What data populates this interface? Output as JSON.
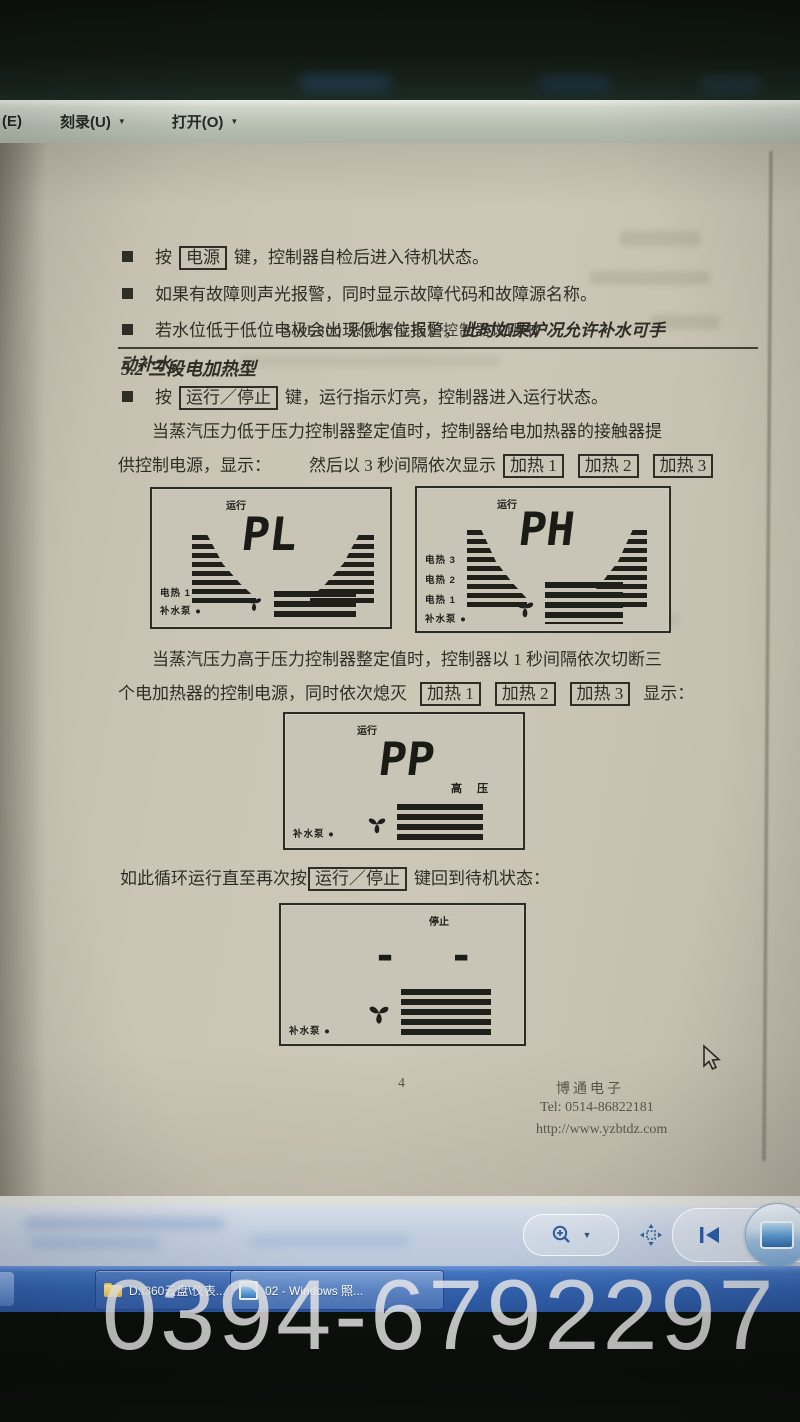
{
  "menu_bar": {
    "edge_item": "(E)",
    "caret": "▼",
    "items": [
      {
        "label": "刻录(U)"
      },
      {
        "label": "打开(O)"
      }
    ]
  },
  "document": {
    "header_title": "SML800 系列智能锅炉控制器说明书",
    "section_heading": "5.2 三段电加热型",
    "bullet_marker": "",
    "bullets": {
      "b1_pre": "按",
      "b1_key": "电源",
      "b1_post": "键，控制器自检后进入待机状态。",
      "b2": "如果有故障则声光报警，同时显示故障代码和故障源名称。",
      "b3_normal": "若水位低于低位电极会出现低水位报警，",
      "b3_em": "此时如果炉况允许补水可手",
      "b3_line2_em": "动补水。",
      "b4_pre": "按",
      "b4_key": "运行／停止",
      "b4_post": "键，运行指示灯亮，控制器进入运行状态。"
    },
    "para1_line1": "当蒸汽压力低于压力控制器整定值时，控制器给电加热器的接触器提",
    "para1_line2_prefix": "供控制电源，显示：",
    "para1_line2_mid": "然后以 3 秒间隔依次显示",
    "heat_buttons": [
      "加热 1",
      "加热 2",
      "加热 3"
    ],
    "para2_line1": "当蒸汽压力高于压力控制器整定值时，控制器以 1 秒间隔依次切断三",
    "para2_line2_prefix": "个电加热器的控制电源，同时依次熄灭",
    "para2_line2_suffix": "显示：",
    "loop_prefix": "如此循环运行直至再次按",
    "loop_key": "运行／停止",
    "loop_suffix": "键回到待机状态：",
    "lcds": [
      {
        "status": "运行",
        "value": "PL",
        "labels": [
          "电热 1",
          "补水泵 ●"
        ]
      },
      {
        "status": "运行",
        "value": "PH",
        "labels": [
          "电热 3",
          "电热 2",
          "电热 1",
          "补水泵 ●"
        ]
      },
      {
        "status": "运行",
        "value": "PP",
        "right_label": "高  压",
        "labels": [
          "补水泵 ●"
        ]
      },
      {
        "status": "停止",
        "value": "- -",
        "labels": [
          "补水泵 ●"
        ]
      }
    ],
    "footer": {
      "page_number": "4",
      "company": "博通电子",
      "tel": "Tel: 0514-86822181",
      "url": "http://www.yzbtdz.com"
    }
  },
  "taskbar": {
    "buttons": [
      {
        "label": "D:\\360云盘\\仪表..."
      },
      {
        "label": "02 - Windows 照..."
      }
    ]
  },
  "watermark": "0394-6792297",
  "colors": {
    "taskbar_blue": "#3261ac",
    "paper": "#ccc7b7",
    "ink": "#2e2e27",
    "watermark_gray": "#eaeaea"
  }
}
